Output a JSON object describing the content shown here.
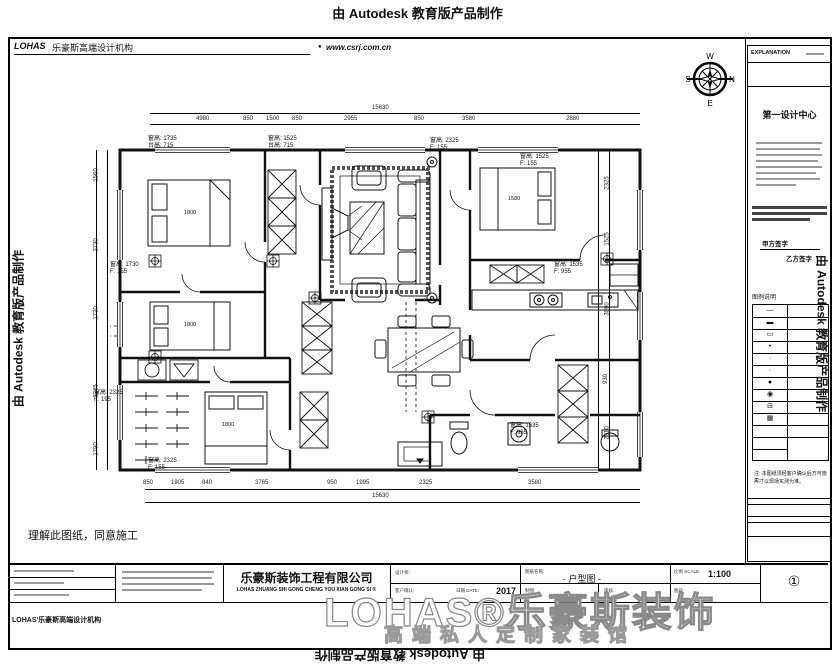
{
  "banners": {
    "top": "由 Autodesk 教育版产品制作",
    "bottom": "由 Autodesk 教育版产品制作",
    "left": "由 Autodesk 教育版产品制作",
    "right": "由 Autodesk 教育版产品制作"
  },
  "header": {
    "logo": "LOHAS",
    "brand": "乐豪斯高端设计机构",
    "bullet": "●",
    "website": "www.csrj.com.cn"
  },
  "compass": {
    "top": "W",
    "right": "N",
    "bottom": "E",
    "left": "S"
  },
  "explanation": {
    "title": "EXPLANATION",
    "heading": "第一设计中心",
    "sig1": "甲方签字",
    "sig2": "乙方签字",
    "legend_title": "图例说明",
    "note_line1": "注: 本图纸须经客户确认后方可施工,",
    "note_line2": "尺寸以现场实测为准。"
  },
  "legend_symbols": [
    "—",
    "▬",
    "▭",
    "•",
    "·",
    "∙",
    "●",
    "◉",
    "⊟",
    "▦"
  ],
  "plan": {
    "labels": [
      "窗高: 1735\n台高: 715",
      "窗高: 1525\n台高: 715",
      "窗高: 2325\nF: 155",
      "窗高: 1525\nF: 155",
      "窗高: 1730\nF: 155",
      "窗高: 1535\nF: 955",
      "窗高: 2325\nF: 195",
      "窗高: 2325\nF: 155",
      "窗高: 1535\nF: 955"
    ],
    "beds": [
      "1800",
      "1800",
      "1800",
      "1580"
    ],
    "dims": {
      "top_total": "15630",
      "bottom_total": "15630",
      "top": [
        "4980",
        "850",
        "1500",
        "850",
        "2955",
        "850",
        "3580",
        "2880"
      ],
      "bottom": [
        "850",
        "1905",
        "840",
        "3765",
        "950",
        "1995",
        "2325",
        "3580"
      ],
      "left": [
        "1560",
        "3730",
        "1730",
        "3245",
        "1790"
      ],
      "right": [
        "2325",
        "1525",
        "3090",
        "930",
        "2310"
      ]
    }
  },
  "note_handwritten": "理解此图纸，同意施工",
  "titleblock": {
    "company": "乐豪斯装饰工程有限公司",
    "company_en": "LOHAS ZHUANG SHI GONG CHENG YOU XIAN GONG SI ®",
    "designer_label": "设计师:",
    "client_label": "客户确认:",
    "date_label": "日期 DATE:",
    "date": "2017",
    "title_label": "图纸名称:",
    "drawing_title": "- 户型图 -",
    "scale_label": "比例 SCALE:",
    "scale": "1:100",
    "draw_label": "制图:",
    "check_label": "审核:",
    "sheet_label": "图号:",
    "sheet_no": "①"
  },
  "watermark": {
    "main": "LOHAS®乐豪斯装饰",
    "sub": "高端私人定制家装馆",
    "bottom_left": "LOHAS'乐豪斯高端设计机构"
  }
}
